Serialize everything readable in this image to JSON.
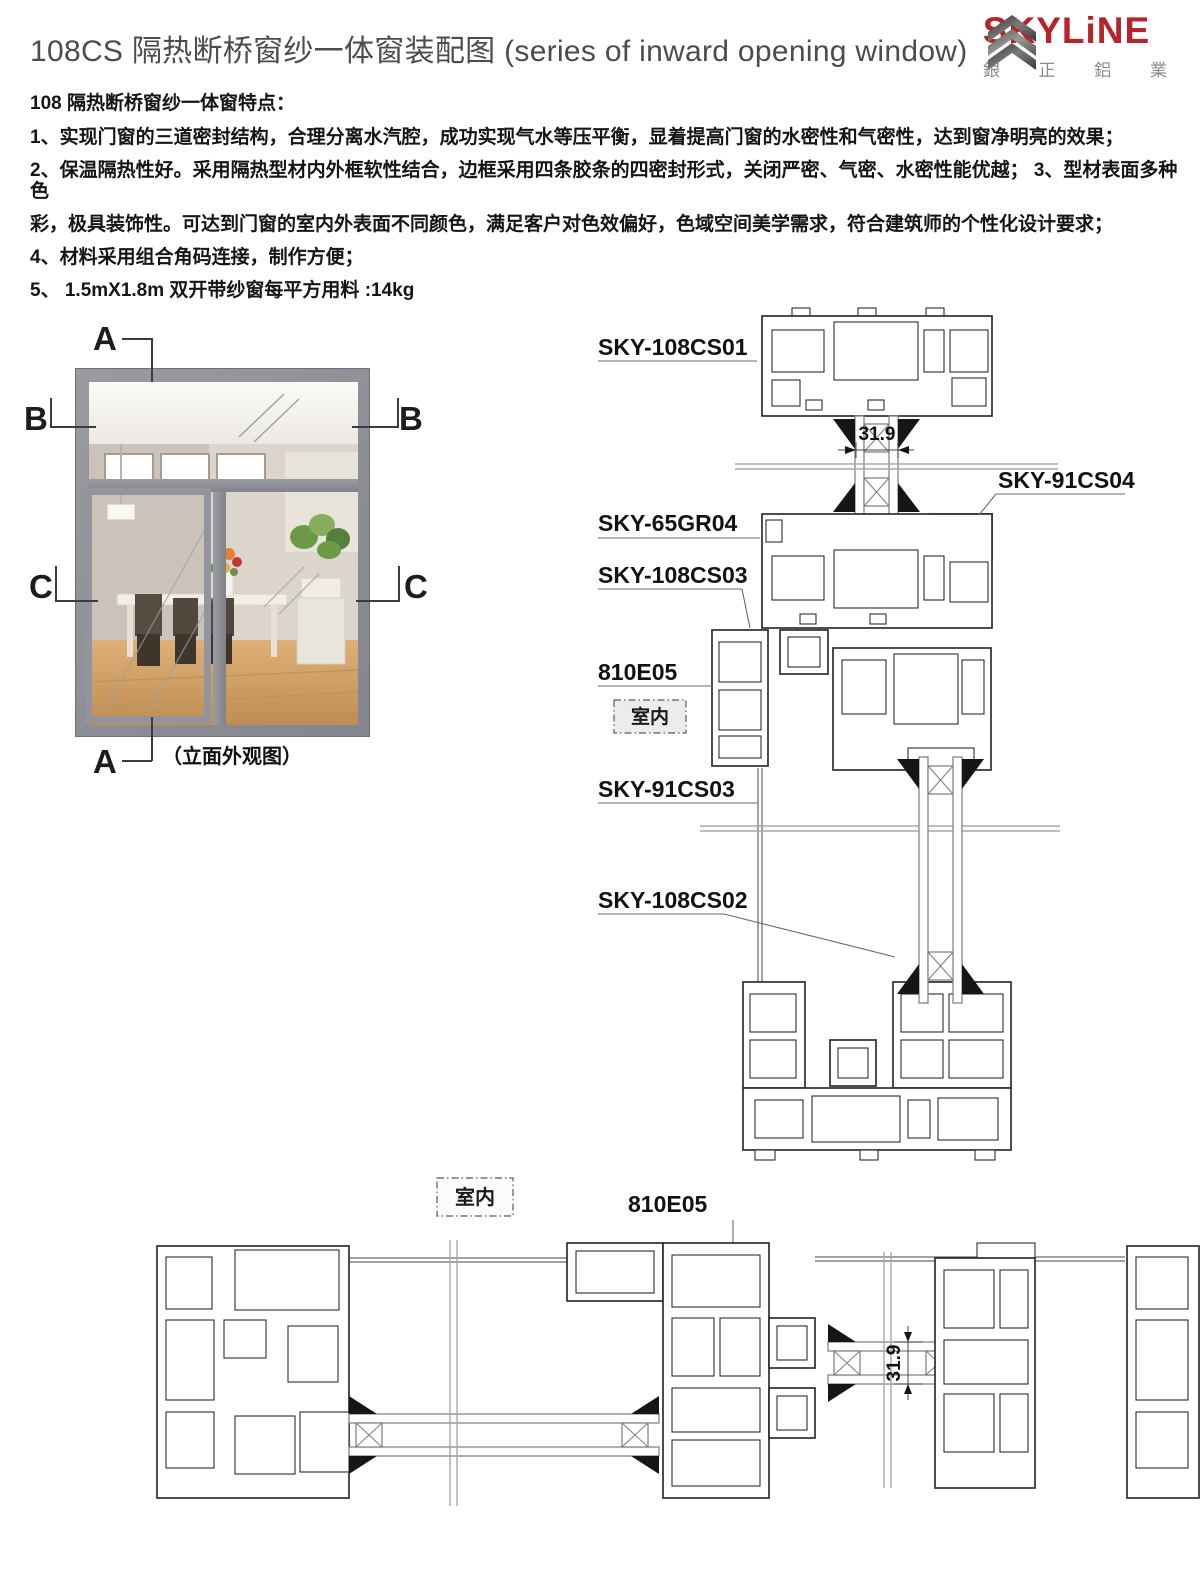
{
  "header": {
    "title": "108CS 隔热断桥窗纱一体窗装配图 (series of inward opening window)",
    "logo": {
      "brand": "SKYLiNE",
      "chinese": "銀 正 鋁 業"
    }
  },
  "features": {
    "heading": "108 隔热断桥窗纱一体窗特点：",
    "lines": [
      "1、实现门窗的三道密封结构，合理分离水汽腔，成功实现气水等压平衡，显着提高门窗的水密性和气密性，达到窗净明亮的效果；",
      "2、保温隔热性好。采用隔热型材内外框软性结合，边框采用四条胶条的四密封形式，关闭严密、气密、水密性能优越； 3、型材表面多种色",
      "彩，极具装饰性。可达到门窗的室内外表面不同颜色，满足客户对色效偏好，色域空间美学需求，符合建筑师的个性化设计要求；",
      "4、材料采用组合角码连接，制作方便；",
      "5、 1.5mX1.8m 双开带纱窗每平方用料 :14kg"
    ]
  },
  "elevation": {
    "caption": "（立面外观图）",
    "labels": {
      "a_top": "A",
      "b_left": "B",
      "b_right": "B",
      "c_left": "C",
      "c_right": "C",
      "a_bottom": "A"
    }
  },
  "vertical_section": {
    "room_label": "室内",
    "dim_glass": "31.9",
    "parts": {
      "p1": "SKY-108CS01",
      "p2": "SKY-91CS04",
      "p3": "SKY-65GR04",
      "p4": "SKY-108CS03",
      "p5": "810E05",
      "p6": "SKY-91CS03",
      "p7": "SKY-108CS02"
    }
  },
  "horizontal_section": {
    "room_label": "室内",
    "part_label": "810E05",
    "dim_glass": "31.9"
  },
  "colors": {
    "brand_red": "#b5232b",
    "brand_gray": "#8b8b8b",
    "frame_gray": "#8f8f95"
  }
}
